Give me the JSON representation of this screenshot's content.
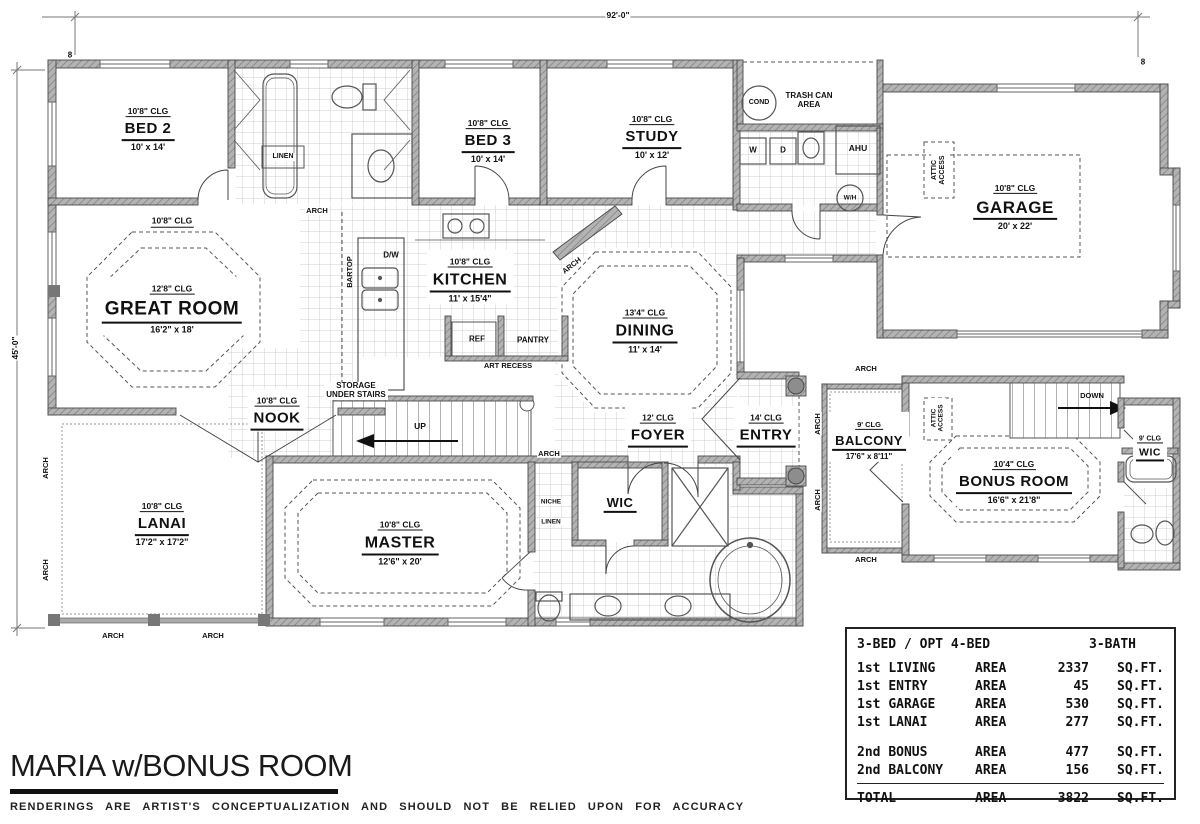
{
  "meta": {
    "title": "MARIA w/BONUS ROOM",
    "disclaimer": "RENDERINGS ARE ARTIST'S CONCEPTUALIZATION AND SHOULD NOT BE RELIED UPON FOR ACCURACY"
  },
  "dims": {
    "width": "92'-0\"",
    "height": "45'-0\""
  },
  "colors": {
    "line": "#3f3f3f",
    "wall_fill": "#b3b3b3",
    "text": "#111111"
  },
  "rooms": {
    "bed2": {
      "clg": "10'8\" CLG",
      "name": "BED 2",
      "dims": "10' x 14'"
    },
    "bed3": {
      "clg": "10'8\" CLG",
      "name": "BED 3",
      "dims": "10' x 14'"
    },
    "study": {
      "clg": "10'8\" CLG",
      "name": "STUDY",
      "dims": "10' x 12'"
    },
    "garage": {
      "clg": "10'8\" CLG",
      "name": "GARAGE",
      "dims": "20' x 22'"
    },
    "great_room": {
      "clg_outer": "10'8\" CLG",
      "clg": "12'8\" CLG",
      "name": "GREAT ROOM",
      "dims": "16'2\" x 18'"
    },
    "kitchen": {
      "clg": "10'8\" CLG",
      "name": "KITCHEN",
      "dims": "11' x 15'4\""
    },
    "dining": {
      "clg": "13'4\" CLG",
      "name": "DINING",
      "dims": "11' x 14'"
    },
    "nook": {
      "clg": "10'8\" CLG",
      "name": "NOOK"
    },
    "foyer": {
      "clg": "12' CLG",
      "name": "FOYER"
    },
    "entry": {
      "clg": "14' CLG",
      "name": "ENTRY"
    },
    "lanai": {
      "clg": "10'8\" CLG",
      "name": "LANAI",
      "dims": "17'2\" x 17'2\""
    },
    "master": {
      "clg": "10'8\" CLG",
      "name": "MASTER",
      "dims": "12'6\" x 20'"
    },
    "wic1": {
      "name": "WIC"
    },
    "balcony": {
      "clg": "9' CLG",
      "name": "BALCONY",
      "dims": "17'6\" x 8'11\""
    },
    "bonus": {
      "clg": "10'4\" CLG",
      "name": "BONUS ROOM",
      "dims": "16'6\" x 21'8\""
    },
    "wic2": {
      "clg": "9' CLG",
      "name": "WIC"
    }
  },
  "labels": {
    "arch": "ARCH",
    "linen": "LINEN",
    "niche": "NICHE",
    "ref": "REF",
    "pantry": "PANTRY",
    "art_recess": "ART RECESS",
    "bartop": "BARTOP",
    "dw": "D/W",
    "storage": "STORAGE UNDER STAIRS",
    "up": "UP",
    "down": "DOWN",
    "washer": "W",
    "dryer": "D",
    "ahu": "AHU",
    "wh": "W/H",
    "cond": "COND",
    "trash": "TRASH CAN AREA",
    "attic": "ATTIC ACCESS",
    "marker": "8"
  },
  "area_table": {
    "header_left": "3-BED / OPT 4-BED",
    "header_right": "3-BATH",
    "rows": [
      {
        "floor": "1st",
        "name": "LIVING",
        "area_label": "AREA",
        "value": "2337",
        "unit": "SQ.FT."
      },
      {
        "floor": "1st",
        "name": "ENTRY",
        "area_label": "AREA",
        "value": "45",
        "unit": "SQ.FT."
      },
      {
        "floor": "1st",
        "name": "GARAGE",
        "area_label": "AREA",
        "value": "530",
        "unit": "SQ.FT."
      },
      {
        "floor": "1st",
        "name": "LANAI",
        "area_label": "AREA",
        "value": "277",
        "unit": "SQ.FT."
      },
      {
        "floor": "2nd",
        "name": "BONUS",
        "area_label": "AREA",
        "value": "477",
        "unit": "SQ.FT."
      },
      {
        "floor": "2nd",
        "name": "BALCONY",
        "area_label": "AREA",
        "value": "156",
        "unit": "SQ.FT."
      }
    ],
    "total": {
      "name": "TOTAL",
      "area_label": "AREA",
      "value": "3822",
      "unit": "SQ.FT."
    }
  }
}
